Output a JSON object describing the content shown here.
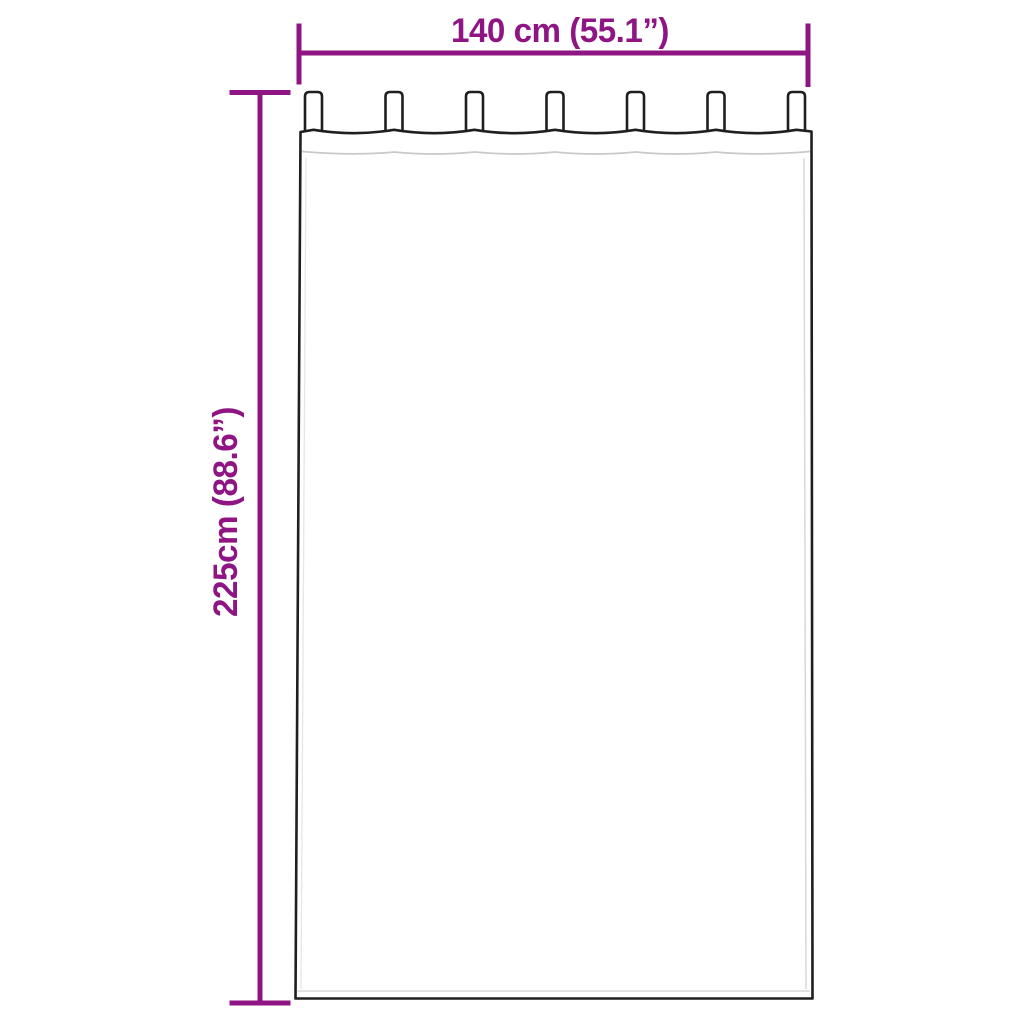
{
  "diagram": {
    "kind": "product-dimension-diagram",
    "subject": "tab-top-curtain",
    "width_dimension": {
      "label": "140 cm (55.1”)"
    },
    "height_dimension": {
      "label": "225cm (88.6”)"
    },
    "curtain": {
      "tab_count": 7
    },
    "colors": {
      "dimension_accent": "#8E1583",
      "curtain_outline": "#1F1F1F",
      "seam_line": "#C9C9C9",
      "background": "#FFFFFF"
    }
  }
}
